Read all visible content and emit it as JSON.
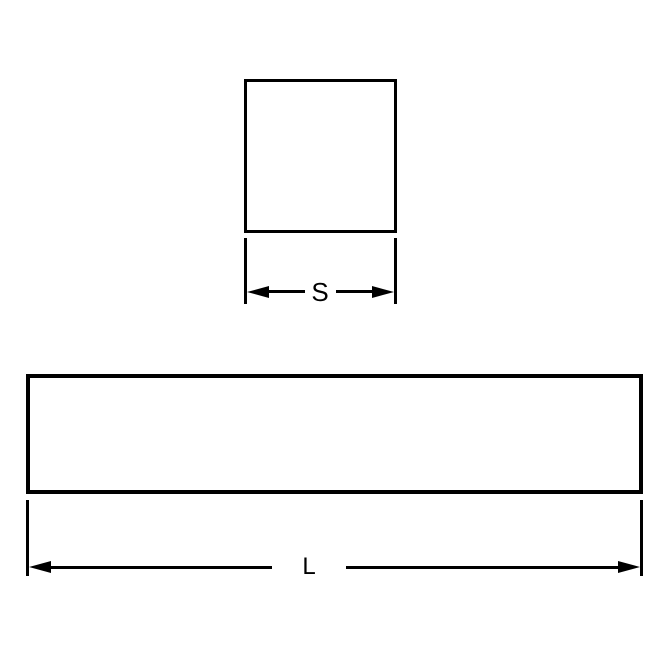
{
  "diagram": {
    "colors": {
      "line": "#000000",
      "background": "#ffffff"
    },
    "dimensions": {
      "side": {
        "label": "S"
      },
      "length": {
        "label": "L"
      }
    }
  }
}
